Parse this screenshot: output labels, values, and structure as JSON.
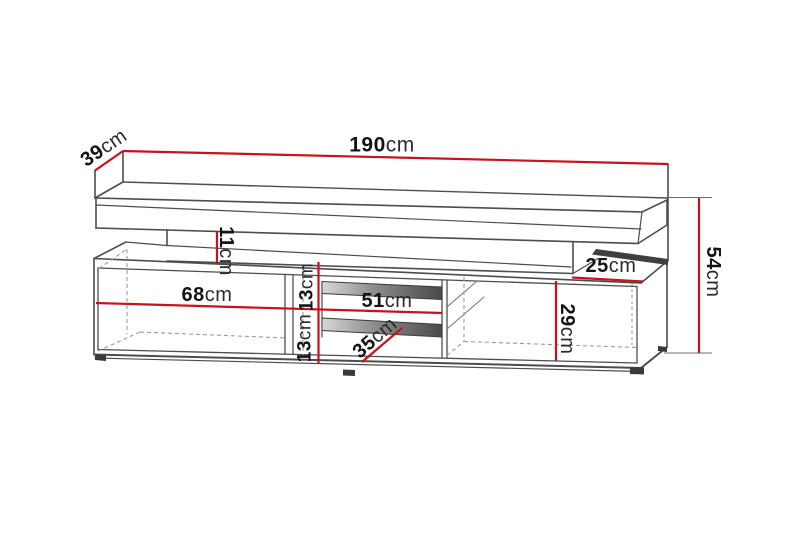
{
  "diagram": {
    "type": "furniture-dimension-drawing",
    "subject": "tv-stand",
    "accent_color": "#c8101e",
    "line_color": "#4d4d4d",
    "hidden_edge_color": "#9a9a9a",
    "unit": "cm"
  },
  "dimensions": {
    "total_width": {
      "value": "190",
      "unit": "cm"
    },
    "top_depth": {
      "value": "39",
      "unit": "cm"
    },
    "gap_height": {
      "value": "11",
      "unit": "cm"
    },
    "total_height": {
      "value": "54",
      "unit": "cm"
    },
    "left_compartment": {
      "value": "68",
      "unit": "cm"
    },
    "shelf_upper_height": {
      "value": "13",
      "unit": "cm"
    },
    "shelf_lower_height": {
      "value": "13",
      "unit": "cm"
    },
    "middle_compartment": {
      "value": "51",
      "unit": "cm"
    },
    "shelf_depth": {
      "value": "35",
      "unit": "cm"
    },
    "right_top_depth": {
      "value": "25",
      "unit": "cm"
    },
    "right_compartment": {
      "value": "29",
      "unit": "cm"
    }
  }
}
